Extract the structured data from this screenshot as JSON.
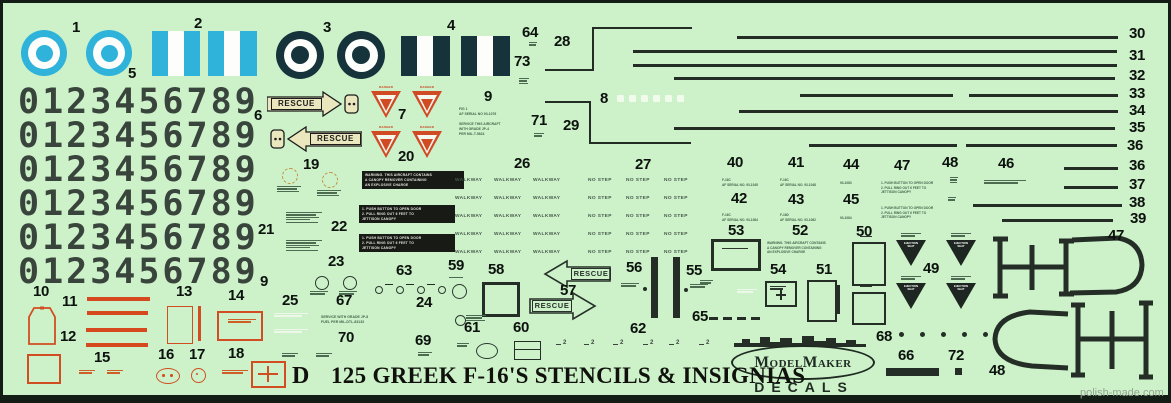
{
  "title": {
    "prefix": "D",
    "text": "125 GREEK F-16'S STENCILS & INSIGNIAS"
  },
  "watermark": "polish-made.com",
  "brand": {
    "name": "ModelMaker",
    "sub": "DECALS"
  },
  "words": {
    "rescue": "RESCUE",
    "walkway": "WALKWAY",
    "no_step": "NO STEP",
    "danger": "DANGER",
    "ejection_seat": "EJECTION SEAT"
  },
  "stencil_texts": {
    "fig_serial": "FIG 1\nAF SERIAL NO 93-1076",
    "service_jp4": "SERVICE THIS AIRCRAFT\nWITH GRADE JP-4\nPER MIL-T-5624",
    "warning_canopy": "WARNING. THIS AIRCRAFT CONTAINS\nA CANOPY REMOVER CONTAINING\nAN EXPLOSIVE CHARGE",
    "jettison_canopy": "1. PUSH BUTTON TO OPEN DOOR\n2. PULL RING OUT 6 FEET TO\nJETTISON CANOPY",
    "service_jp8": "SERVICE WITH GRADE JP-8\nFUEL PER MIL-DTL-83133",
    "serial_40": "F-16C\nAF SERIAL NO. 93-1045",
    "serial_41": "F-16C\nAF SERIAL NO. 93-1048",
    "serial_42": "F-16C\nAF SERIAL NO. 93-1084",
    "serial_43": "F-16D\nAF SERIAL NO. 93-1082",
    "code_44": "93-1083",
    "code_45": "93-1084"
  },
  "digits": {
    "value": "0123456789",
    "rows_y": [
      85,
      119,
      153,
      187,
      221,
      255
    ]
  },
  "colors": {
    "sheet_green": "#cdf2c9",
    "ink": "#232d26",
    "digits": "#39453c",
    "hellenic_blue": "#2fb3da",
    "hellenic_navy": "#16333c",
    "stencil_red": "#d04a24",
    "rescue_cream": "#eae6bd",
    "black_block": "#181a16"
  },
  "part_labels": [
    {
      "n": "1",
      "x": 72,
      "y": 20
    },
    {
      "n": "2",
      "x": 194,
      "y": 16
    },
    {
      "n": "3",
      "x": 323,
      "y": 20
    },
    {
      "n": "4",
      "x": 447,
      "y": 18
    },
    {
      "n": "5",
      "x": 128,
      "y": 66
    },
    {
      "n": "6",
      "x": 254,
      "y": 108
    },
    {
      "n": "7",
      "x": 398,
      "y": 107
    },
    {
      "n": "8",
      "x": 600,
      "y": 91
    },
    {
      "n": "9",
      "x": 484,
      "y": 89
    },
    {
      "n": "9",
      "x": 260,
      "y": 274
    },
    {
      "n": "10",
      "x": 33,
      "y": 284
    },
    {
      "n": "11",
      "x": 62,
      "y": 294
    },
    {
      "n": "12",
      "x": 60,
      "y": 329
    },
    {
      "n": "13",
      "x": 176,
      "y": 284
    },
    {
      "n": "14",
      "x": 228,
      "y": 288
    },
    {
      "n": "15",
      "x": 94,
      "y": 350
    },
    {
      "n": "16",
      "x": 158,
      "y": 347
    },
    {
      "n": "17",
      "x": 189,
      "y": 347
    },
    {
      "n": "18",
      "x": 228,
      "y": 346
    },
    {
      "n": "19",
      "x": 303,
      "y": 157
    },
    {
      "n": "20",
      "x": 398,
      "y": 149
    },
    {
      "n": "21",
      "x": 258,
      "y": 222
    },
    {
      "n": "22",
      "x": 331,
      "y": 219
    },
    {
      "n": "23",
      "x": 328,
      "y": 254
    },
    {
      "n": "24",
      "x": 416,
      "y": 295
    },
    {
      "n": "25",
      "x": 282,
      "y": 293
    },
    {
      "n": "26",
      "x": 514,
      "y": 156
    },
    {
      "n": "27",
      "x": 635,
      "y": 157
    },
    {
      "n": "28",
      "x": 554,
      "y": 34
    },
    {
      "n": "29",
      "x": 563,
      "y": 118
    },
    {
      "n": "30",
      "x": 1129,
      "y": 26
    },
    {
      "n": "31",
      "x": 1129,
      "y": 48
    },
    {
      "n": "32",
      "x": 1129,
      "y": 68
    },
    {
      "n": "33",
      "x": 1129,
      "y": 86
    },
    {
      "n": "34",
      "x": 1129,
      "y": 103
    },
    {
      "n": "35",
      "x": 1129,
      "y": 120
    },
    {
      "n": "36",
      "x": 1127,
      "y": 138
    },
    {
      "n": "36",
      "x": 1129,
      "y": 158
    },
    {
      "n": "37",
      "x": 1129,
      "y": 177
    },
    {
      "n": "38",
      "x": 1129,
      "y": 195
    },
    {
      "n": "39",
      "x": 1130,
      "y": 211
    },
    {
      "n": "40",
      "x": 727,
      "y": 155
    },
    {
      "n": "41",
      "x": 788,
      "y": 155
    },
    {
      "n": "42",
      "x": 731,
      "y": 191
    },
    {
      "n": "43",
      "x": 788,
      "y": 192
    },
    {
      "n": "44",
      "x": 843,
      "y": 157
    },
    {
      "n": "45",
      "x": 843,
      "y": 192
    },
    {
      "n": "46",
      "x": 998,
      "y": 156
    },
    {
      "n": "47",
      "x": 894,
      "y": 158
    },
    {
      "n": "47",
      "x": 1108,
      "y": 228
    },
    {
      "n": "48",
      "x": 942,
      "y": 155
    },
    {
      "n": "48",
      "x": 989,
      "y": 363
    },
    {
      "n": "49",
      "x": 923,
      "y": 261
    },
    {
      "n": "50",
      "x": 856,
      "y": 224
    },
    {
      "n": "51",
      "x": 816,
      "y": 262
    },
    {
      "n": "52",
      "x": 792,
      "y": 223
    },
    {
      "n": "53",
      "x": 728,
      "y": 223
    },
    {
      "n": "54",
      "x": 770,
      "y": 262
    },
    {
      "n": "55",
      "x": 686,
      "y": 263
    },
    {
      "n": "56",
      "x": 626,
      "y": 260
    },
    {
      "n": "57",
      "x": 560,
      "y": 283
    },
    {
      "n": "58",
      "x": 488,
      "y": 262
    },
    {
      "n": "59",
      "x": 448,
      "y": 258
    },
    {
      "n": "60",
      "x": 513,
      "y": 320
    },
    {
      "n": "61",
      "x": 464,
      "y": 320
    },
    {
      "n": "62",
      "x": 630,
      "y": 321
    },
    {
      "n": "63",
      "x": 396,
      "y": 263
    },
    {
      "n": "64",
      "x": 522,
      "y": 25
    },
    {
      "n": "65",
      "x": 692,
      "y": 309
    },
    {
      "n": "66",
      "x": 898,
      "y": 348
    },
    {
      "n": "67",
      "x": 336,
      "y": 293
    },
    {
      "n": "68",
      "x": 876,
      "y": 329
    },
    {
      "n": "69",
      "x": 415,
      "y": 333
    },
    {
      "n": "70",
      "x": 338,
      "y": 330
    },
    {
      "n": "71",
      "x": 531,
      "y": 113
    },
    {
      "n": "72",
      "x": 948,
      "y": 348
    },
    {
      "n": "73",
      "x": 514,
      "y": 54
    }
  ],
  "fuselage_lines": [
    {
      "y": 36,
      "segs": [
        [
          737,
          1118
        ]
      ]
    },
    {
      "y": 50,
      "segs": [
        [
          633,
          1117
        ]
      ]
    },
    {
      "y": 64,
      "segs": [
        [
          633,
          1117
        ]
      ]
    },
    {
      "y": 77,
      "segs": [
        [
          674,
          1115
        ]
      ]
    },
    {
      "y": 94,
      "segs": [
        [
          800,
          953
        ],
        [
          969,
          1118
        ]
      ]
    },
    {
      "y": 110,
      "segs": [
        [
          739,
          1118
        ]
      ]
    },
    {
      "y": 127,
      "segs": [
        [
          674,
          1115
        ]
      ]
    },
    {
      "y": 144,
      "segs": [
        [
          809,
          957
        ],
        [
          966,
          1117
        ]
      ]
    },
    {
      "y": 167,
      "segs": [
        [
          1064,
          1118
        ]
      ]
    },
    {
      "y": 186,
      "segs": [
        [
          1064,
          1118
        ]
      ]
    },
    {
      "y": 204,
      "segs": [
        [
          973,
          1122
        ]
      ]
    },
    {
      "y": 219,
      "segs": [
        [
          1002,
          1113
        ]
      ]
    }
  ],
  "grid": {
    "rows_y": [
      179,
      197,
      215,
      233,
      251
    ],
    "walkway_x": [
      455,
      494,
      533
    ],
    "nostep_x": [
      588,
      626,
      664
    ]
  },
  "danger_triangles": [
    {
      "x": 371,
      "y": 86
    },
    {
      "x": 412,
      "y": 86
    },
    {
      "x": 371,
      "y": 126
    },
    {
      "x": 412,
      "y": 126
    }
  ],
  "eject_triangles": [
    {
      "x": 896,
      "y": 233
    },
    {
      "x": 946,
      "y": 233
    },
    {
      "x": 896,
      "y": 276
    },
    {
      "x": 946,
      "y": 276
    }
  ],
  "micro_blocks": [
    {
      "x": 277,
      "y": 186,
      "w": 24,
      "n": 3,
      "c": "g"
    },
    {
      "x": 317,
      "y": 190,
      "w": 24,
      "n": 3,
      "c": "g"
    },
    {
      "x": 286,
      "y": 212,
      "w": 36,
      "n": 5,
      "c": "g"
    },
    {
      "x": 286,
      "y": 240,
      "w": 36,
      "n": 5,
      "c": "g"
    },
    {
      "x": 310,
      "y": 291,
      "w": 18,
      "n": 2,
      "c": "g"
    },
    {
      "x": 339,
      "y": 291,
      "w": 18,
      "n": 2,
      "c": "g"
    },
    {
      "x": 449,
      "y": 277,
      "w": 14,
      "n": 1,
      "c": "g"
    },
    {
      "x": 466,
      "y": 315,
      "w": 20,
      "n": 3,
      "c": "g"
    },
    {
      "x": 621,
      "y": 283,
      "w": 18,
      "n": 2,
      "c": "g"
    },
    {
      "x": 690,
      "y": 284,
      "w": 18,
      "n": 2,
      "c": "g"
    },
    {
      "x": 457,
      "y": 343,
      "w": 12,
      "n": 2,
      "c": "g"
    },
    {
      "x": 222,
      "y": 370,
      "w": 26,
      "n": 2,
      "c": "o"
    },
    {
      "x": 79,
      "y": 370,
      "w": 16,
      "n": 2,
      "c": "o"
    },
    {
      "x": 107,
      "y": 370,
      "w": 16,
      "n": 2,
      "c": "o"
    },
    {
      "x": 228,
      "y": 319,
      "w": 28,
      "n": 2,
      "c": "o"
    },
    {
      "x": 722,
      "y": 248,
      "w": 26,
      "n": 1,
      "c": "d"
    },
    {
      "x": 770,
      "y": 286,
      "w": 16,
      "n": 2,
      "c": "d"
    },
    {
      "x": 737,
      "y": 289,
      "w": 20,
      "n": 2,
      "c": "w"
    },
    {
      "x": 274,
      "y": 313,
      "w": 34,
      "n": 2,
      "c": "w"
    },
    {
      "x": 274,
      "y": 329,
      "w": 34,
      "n": 2,
      "c": "w"
    },
    {
      "x": 860,
      "y": 236,
      "w": 12,
      "n": 1,
      "c": "d"
    },
    {
      "x": 860,
      "y": 286,
      "w": 12,
      "n": 1,
      "c": "d"
    },
    {
      "x": 950,
      "y": 177,
      "w": 8,
      "n": 3,
      "c": "g"
    },
    {
      "x": 948,
      "y": 197,
      "w": 8,
      "n": 2,
      "c": "g"
    },
    {
      "x": 984,
      "y": 180,
      "w": 42,
      "n": 2,
      "c": "g"
    },
    {
      "x": 534,
      "y": 133,
      "w": 10,
      "n": 2,
      "c": "g"
    },
    {
      "x": 529,
      "y": 42,
      "w": 8,
      "n": 2,
      "c": "g"
    },
    {
      "x": 519,
      "y": 78,
      "w": 10,
      "n": 3,
      "c": "g"
    },
    {
      "x": 418,
      "y": 352,
      "w": 14,
      "n": 2,
      "c": "g"
    },
    {
      "x": 282,
      "y": 353,
      "w": 16,
      "n": 2,
      "c": "g"
    },
    {
      "x": 316,
      "y": 353,
      "w": 16,
      "n": 2,
      "c": "g"
    },
    {
      "x": 700,
      "y": 280,
      "w": 13,
      "n": 2,
      "c": "g"
    }
  ],
  "circles63": {
    "y": 286,
    "xs": [
      375,
      396,
      417,
      438
    ],
    "d": 6,
    "dash_y": 284,
    "dash_xs": [
      385,
      406,
      427
    ]
  },
  "dots68": {
    "y": 332,
    "xs": [
      899,
      920,
      941,
      962,
      983
    ],
    "d": 5
  },
  "dashes65": {
    "y": 317,
    "xs": [
      709,
      723,
      737,
      751
    ],
    "w": 9,
    "h": 2.5
  },
  "white8": {
    "y": 95,
    "xs": [
      617,
      629,
      641,
      653,
      665,
      677
    ],
    "w": 7,
    "h": 7
  },
  "tiny2": {
    "glyph": "2",
    "y": 340,
    "xs": [
      563,
      591,
      620,
      650,
      676,
      706
    ]
  }
}
